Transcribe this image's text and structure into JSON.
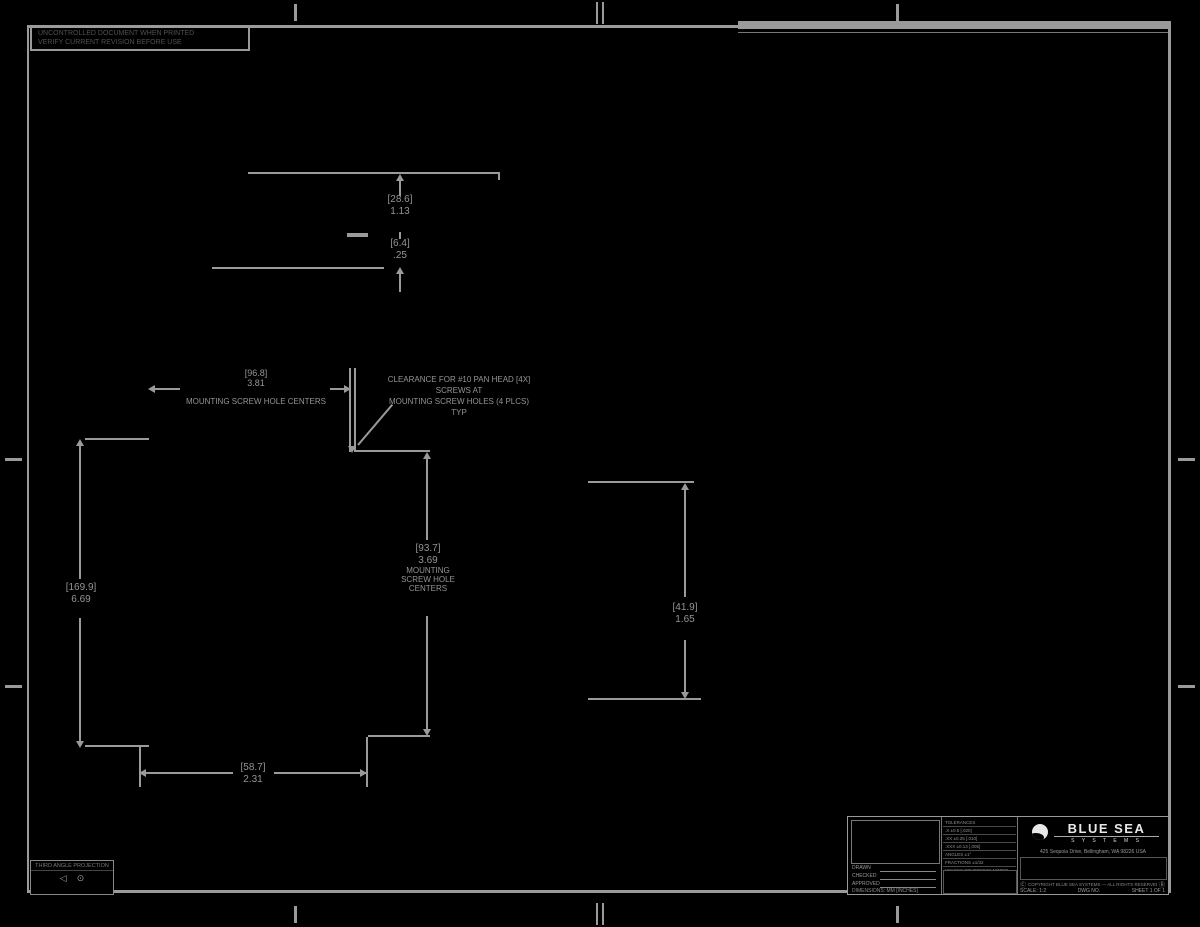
{
  "colors": {
    "background": "#000000",
    "line": "#9a9a9a",
    "text": "#949494",
    "brand_text": "#e8e8e8"
  },
  "stamp": {
    "line1": "UNCONTROLLED DOCUMENT WHEN PRINTED",
    "line2": "VERIFY CURRENT REVISION BEFORE USE"
  },
  "views": {
    "detail": {
      "dim_a_mm": "[28.6]",
      "dim_a_in": "1.13",
      "dim_b_mm": "[6.4]",
      "dim_b_in": ".25"
    },
    "plan": {
      "left_mm": "[169.9]",
      "left_in": "6.69",
      "bottom_mm": "[58.7]",
      "bottom_in": "2.31",
      "center_mm": "[93.7]",
      "center_in": "3.69",
      "center_l3": "MOUNTING",
      "center_l4": "SCREW HOLE",
      "center_l5": "CENTERS",
      "top_mm": "[96.8]",
      "top_in": "3.81",
      "top_note": "MOUNTING SCREW HOLE CENTERS",
      "callout_l1": "CLEARANCE FOR #10 PAN HEAD [4X]",
      "callout_l2": "SCREWS AT",
      "callout_l3": "MOUNTING SCREW HOLES (4 PLCS)",
      "callout_l4": "TYP"
    },
    "side": {
      "dim_mm": "[41.9]",
      "dim_in": "1.65"
    }
  },
  "projection_box": {
    "label": "THIRD ANGLE PROJECTION",
    "sym1": "◁",
    "sym2": "⊙"
  },
  "title_block": {
    "fields": {
      "f1": "DRAWN",
      "f2": "CHECKED",
      "f3": "APPROVED",
      "note": "DIMENSIONS: MM [INCHES]"
    },
    "tolerances": {
      "rows": [
        "TOLERANCES",
        ".X  ±0.5  [.020]",
        ".XX  ±0.25  [.010]",
        ".XXX  ±0.13  [.005]",
        "ANGLES  ±1°",
        "FRACTIONS  ±1/32",
        "UNLESS OTHERWISE NOTED"
      ]
    },
    "brand": {
      "name": "BLUE SEA",
      "sub": "S Y S T E M S"
    },
    "address": "425 Sequoia Drive, Bellingham, WA 98226 USA",
    "copyright_sym_left": "Ⓒ",
    "copyright": "COPYRIGHT BLUE SEA SYSTEMS — ALL RIGHTS RESERVED",
    "copyright_sym_right": "Ⓡ",
    "scale": "SCALE: 1:2",
    "dwg_no": "DWG NO.",
    "sheet": "SHEET 1 OF 1"
  }
}
